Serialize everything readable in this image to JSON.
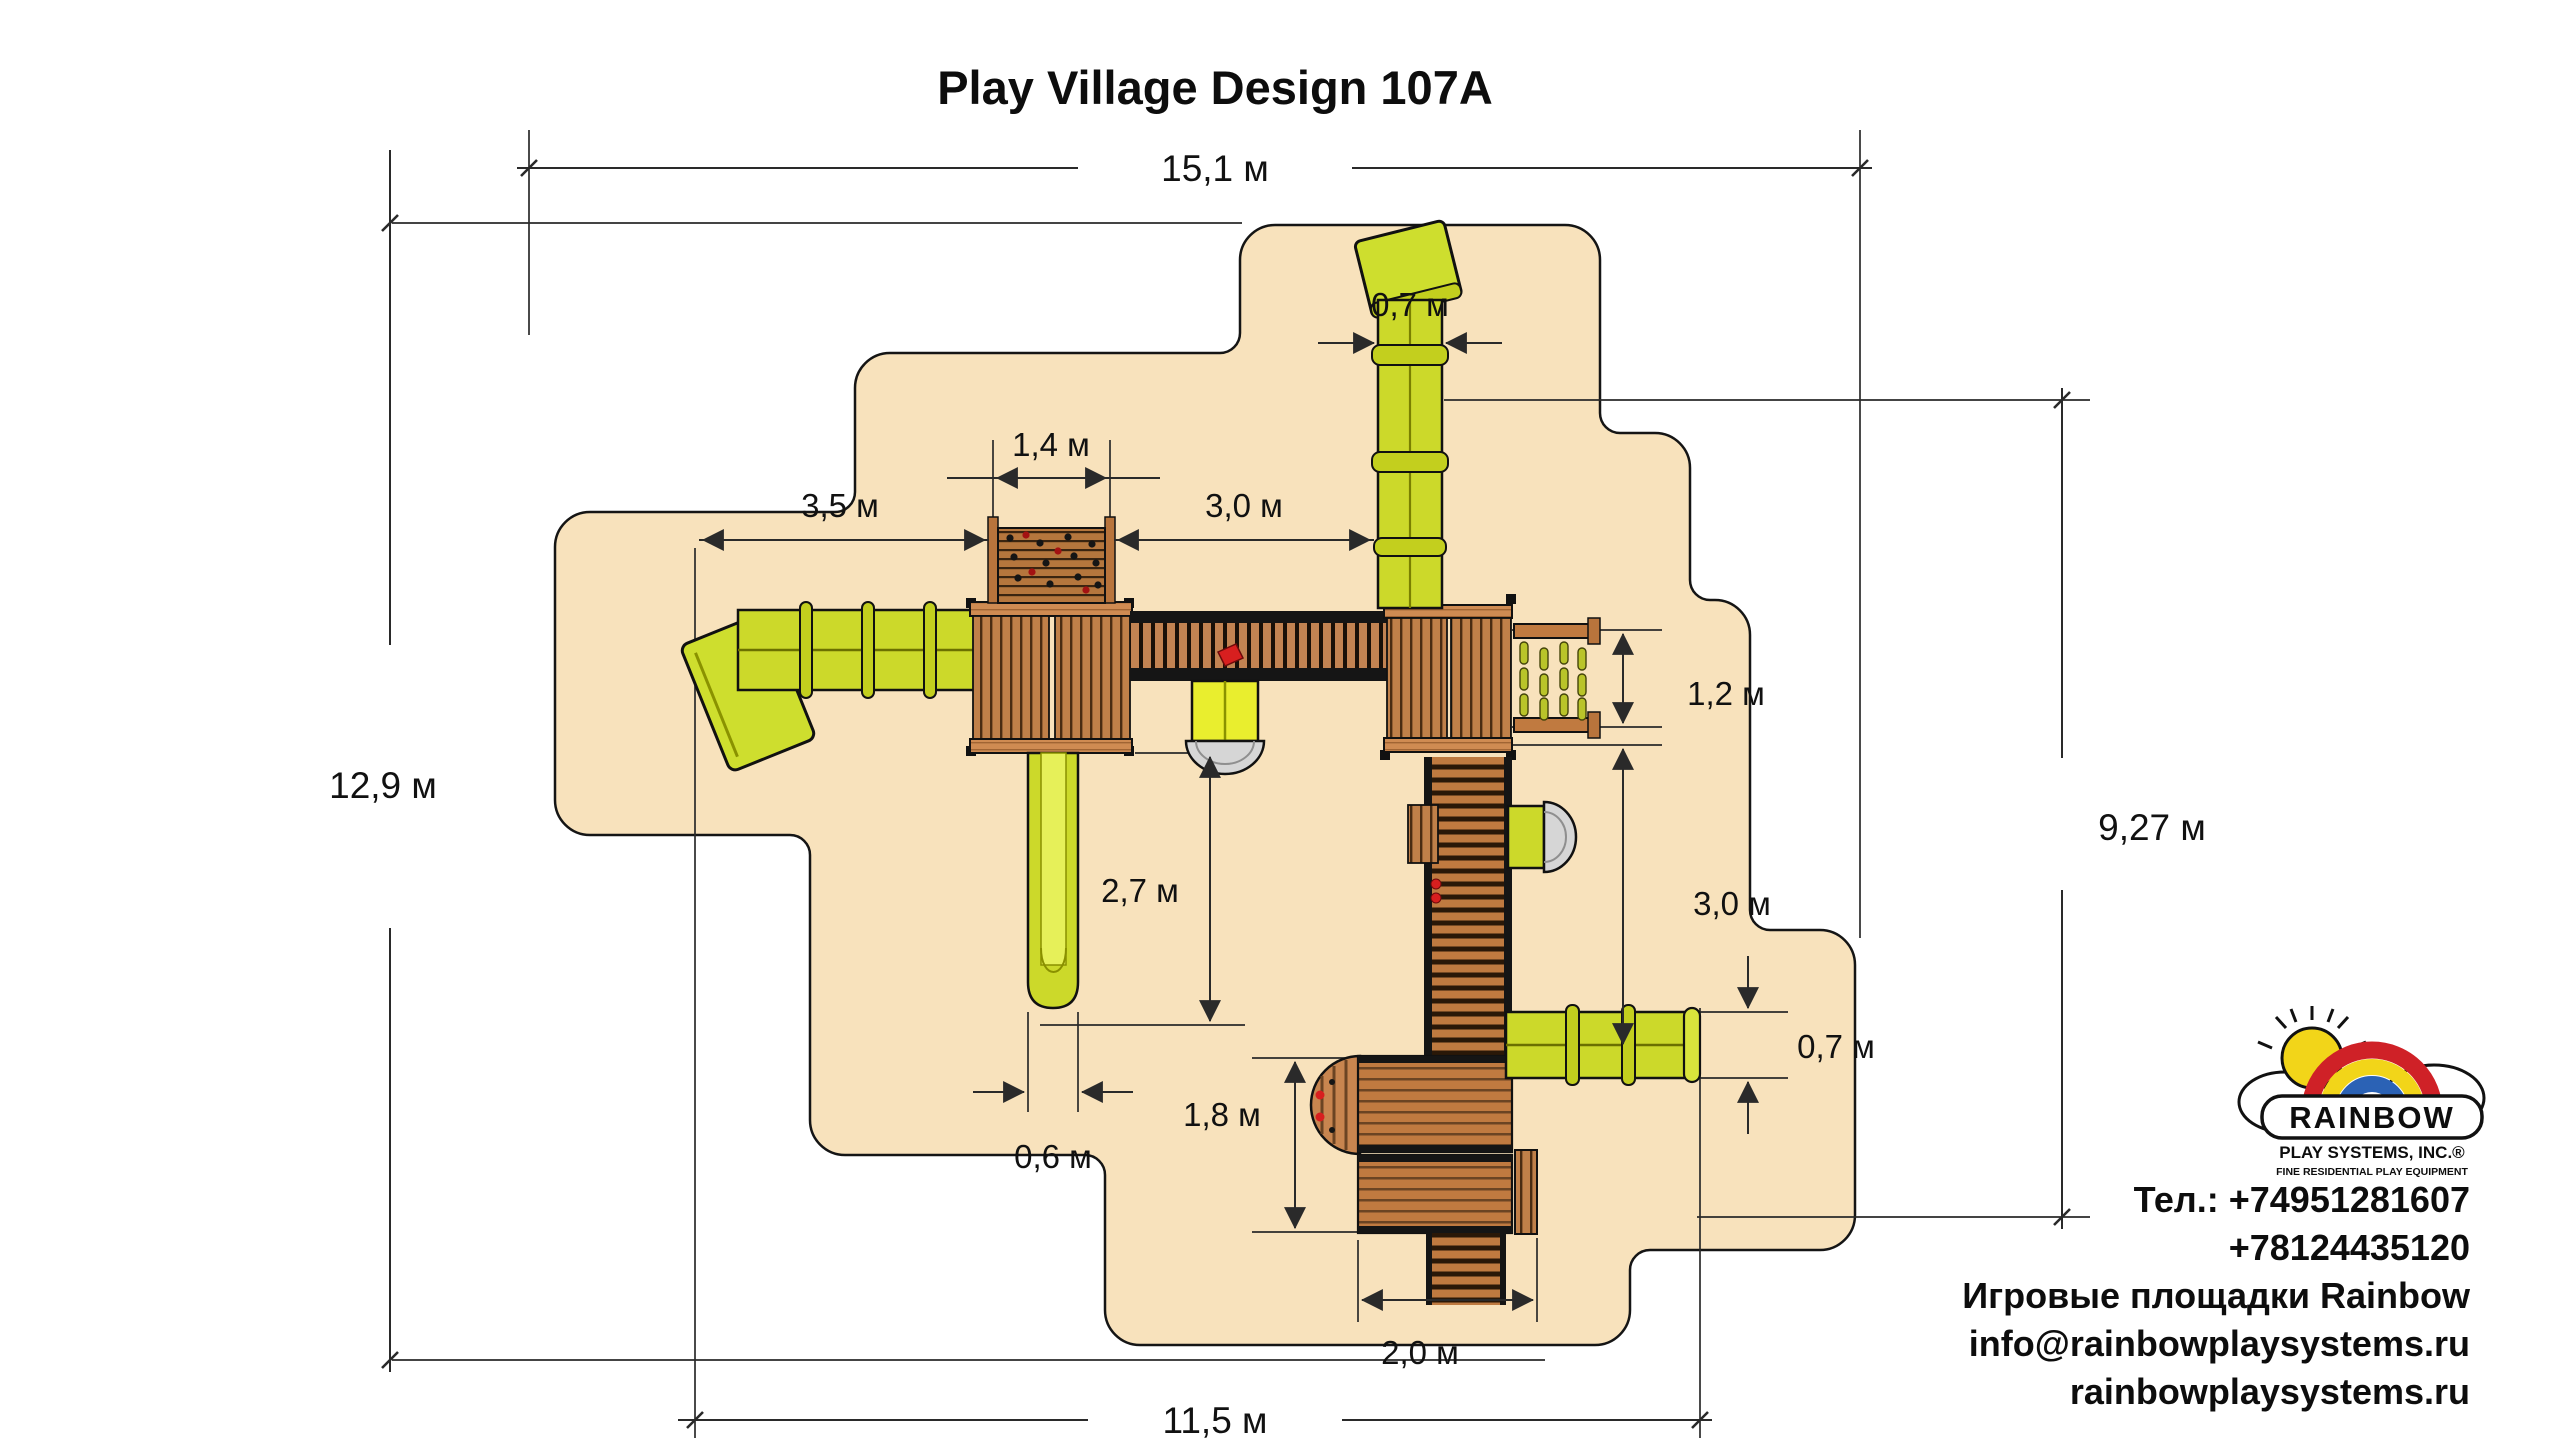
{
  "title": "Play Village Design 107A",
  "dimensions": {
    "overall_width": "15,1 м",
    "overall_depth": "12,9 м",
    "structure_width": "11,5 м",
    "structure_depth": "9,27 м",
    "top_tube_width": "0,7 м",
    "climb_wall_width": "1,4 м",
    "left_clearance": "3,5 м",
    "top_clearance": "3,0 м",
    "monkey_bars_width": "1,2 м",
    "right_clearance": "3,0 м",
    "slide_clearance": "2,7 м",
    "slide_width": "0,6 м",
    "lower_tower_depth": "1,8 м",
    "bottom_tube_width": "0,7 м",
    "lower_tower_width": "2,0 м"
  },
  "logo": {
    "brand": "RAINBOW",
    "subtitle": "PLAY SYSTEMS, INC.®",
    "tagline": "FINE RESIDENTIAL PLAY EQUIPMENT"
  },
  "contact": {
    "lines": [
      "Тел.: +74951281607",
      "+78124435120",
      "Игровые площадки Rainbow",
      "info@rainbowplaysystems.ru",
      "rainbowplaysystems.ru"
    ]
  },
  "colors": {
    "sand": "#f8e2bc",
    "wood": "#c08049",
    "wood_cap": "#cf8b52",
    "slide_yellow": "#ccd92a",
    "accent_red": "#d81f1f",
    "outline": "#1a1a1a",
    "rainbow_red": "#cf2127",
    "rainbow_yellow": "#f2d519",
    "rainbow_blue": "#2b62b5"
  }
}
